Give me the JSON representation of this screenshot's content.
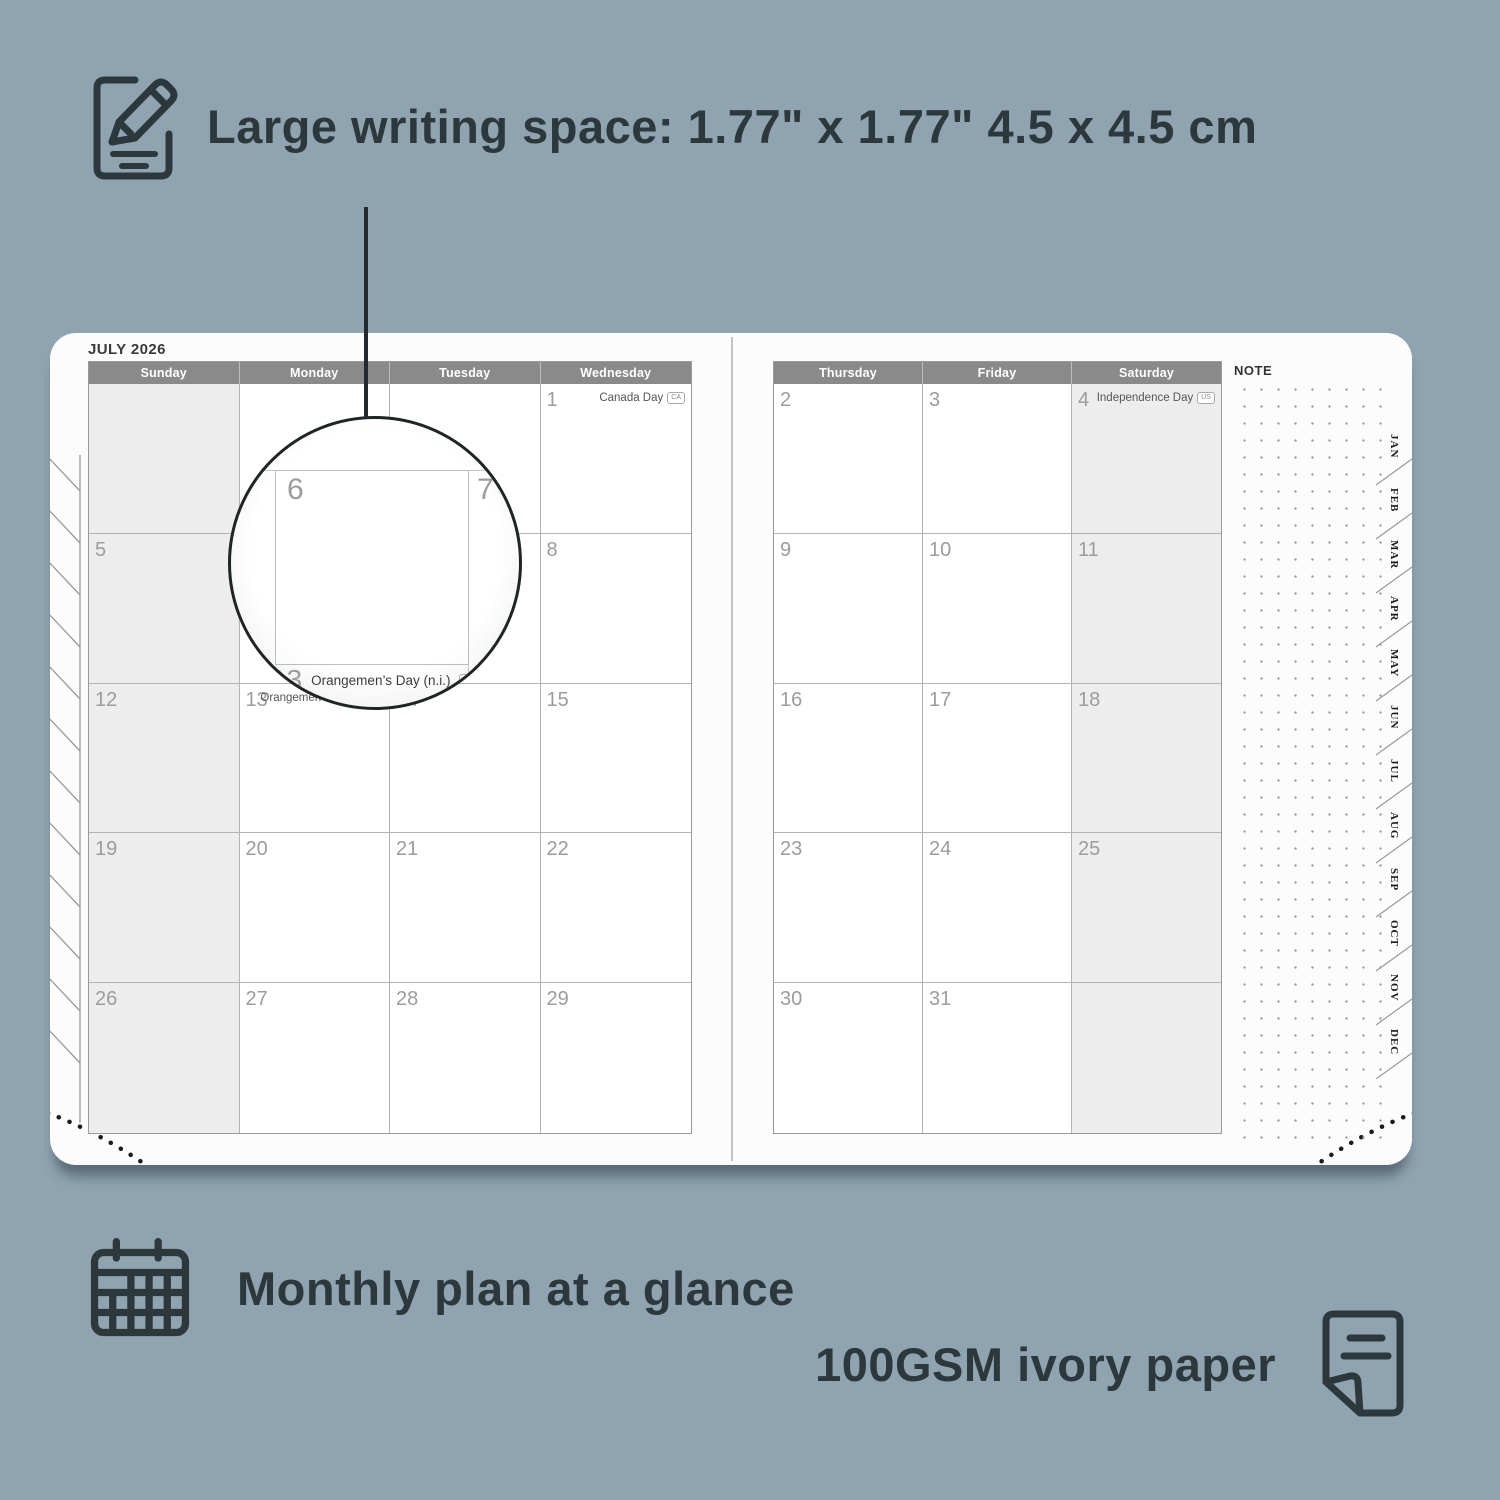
{
  "features": {
    "writing_space": "Large writing space: 1.77\" x 1.77\" 4.5 x 4.5 cm",
    "monthly_plan": "Monthly plan at a glance",
    "paper": "100GSM ivory paper"
  },
  "planner": {
    "month_title": "JULY 2026",
    "note_label": "NOTE",
    "month_tabs": [
      "JAN",
      "FEB",
      "MAR",
      "APR",
      "MAY",
      "JUN",
      "JUL",
      "AUG",
      "SEP",
      "OCT",
      "NOV",
      "DEC"
    ],
    "grids": [
      {
        "id": "left",
        "headers": [
          "Sunday",
          "Monday",
          "Tuesday",
          "Wednesday"
        ],
        "weekend_col": 0,
        "rows": [
          [
            {
              "day": ""
            },
            {
              "day": ""
            },
            {
              "day": ""
            },
            {
              "day": "1",
              "holiday": "Canada Day",
              "flag": "CA"
            }
          ],
          [
            {
              "day": "5"
            },
            {
              "day": "6"
            },
            {
              "day": "7"
            },
            {
              "day": "8"
            }
          ],
          [
            {
              "day": "12"
            },
            {
              "day": "13",
              "holiday": "Orangemen’s Day (n.i.)",
              "flag": "UK"
            },
            {
              "day": "14"
            },
            {
              "day": "15"
            }
          ],
          [
            {
              "day": "19"
            },
            {
              "day": "20"
            },
            {
              "day": "21"
            },
            {
              "day": "22"
            }
          ],
          [
            {
              "day": "26"
            },
            {
              "day": "27"
            },
            {
              "day": "28"
            },
            {
              "day": "29"
            }
          ]
        ]
      },
      {
        "id": "right",
        "headers": [
          "Thursday",
          "Friday",
          "Saturday"
        ],
        "weekend_col": 2,
        "rows": [
          [
            {
              "day": "2"
            },
            {
              "day": "3"
            },
            {
              "day": "4",
              "holiday": "Independence Day",
              "flag": "US"
            }
          ],
          [
            {
              "day": "9"
            },
            {
              "day": "10"
            },
            {
              "day": "11"
            }
          ],
          [
            {
              "day": "16"
            },
            {
              "day": "17"
            },
            {
              "day": "18"
            }
          ],
          [
            {
              "day": "23"
            },
            {
              "day": "24"
            },
            {
              "day": "25"
            }
          ],
          [
            {
              "day": "30"
            },
            {
              "day": "31"
            },
            {
              "day": ""
            }
          ]
        ]
      }
    ],
    "magnifier": {
      "day_left": "6",
      "day_right": "7",
      "footer_day": "13",
      "footer_holiday": "Orangemen’s Day (n.i.)",
      "footer_flag": "UK"
    }
  },
  "colors": {
    "background": "#8fa3b0",
    "ink": "#2d383d",
    "header_gray": "#8a8a8a",
    "weekend_shade": "#ededed",
    "grid_line": "#b3b3b3",
    "callout_line": "#23292d"
  }
}
